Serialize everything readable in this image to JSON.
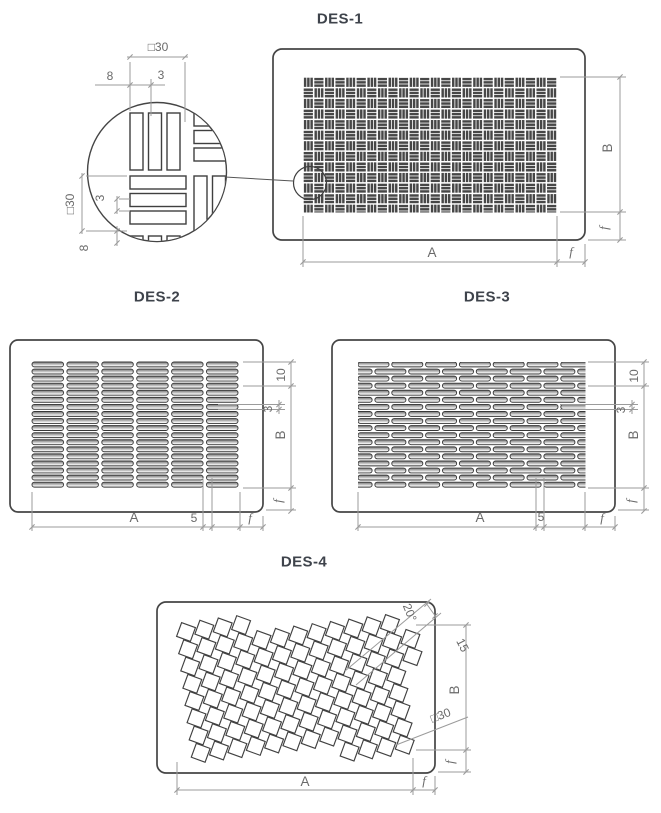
{
  "titles": {
    "des1": "DES-1",
    "des2": "DES-2",
    "des3": "DES-3",
    "des4": "DES-4"
  },
  "detail": {
    "size_top": "□30",
    "gap_top": "8",
    "slot_top": "3",
    "size_left": "□30",
    "slot_left": "3",
    "gap_left": "8"
  },
  "des1": {
    "height": "B",
    "frame_right": "f",
    "width": "A",
    "frame_bottom": "f"
  },
  "des2": {
    "pitch": "10",
    "slot": "3",
    "height": "B",
    "frame_right": "f",
    "width": "A",
    "gap": "5",
    "frame_bottom": "f"
  },
  "des3": {
    "pitch": "10",
    "slot": "3",
    "height": "B",
    "frame_right": "f",
    "width": "A",
    "gap": "5",
    "frame_bottom": "f"
  },
  "des4": {
    "angle": "20°",
    "pitch": "15",
    "square": "□30",
    "height": "B",
    "frame_right": "f",
    "width": "A",
    "frame_bottom": "f"
  },
  "colors": {
    "panel_line": "#454545",
    "pattern_line": "#3f3f3f",
    "dim_line": "#9b9b9b",
    "dim_text": "#6a6a6a",
    "title": "#3e434b"
  }
}
